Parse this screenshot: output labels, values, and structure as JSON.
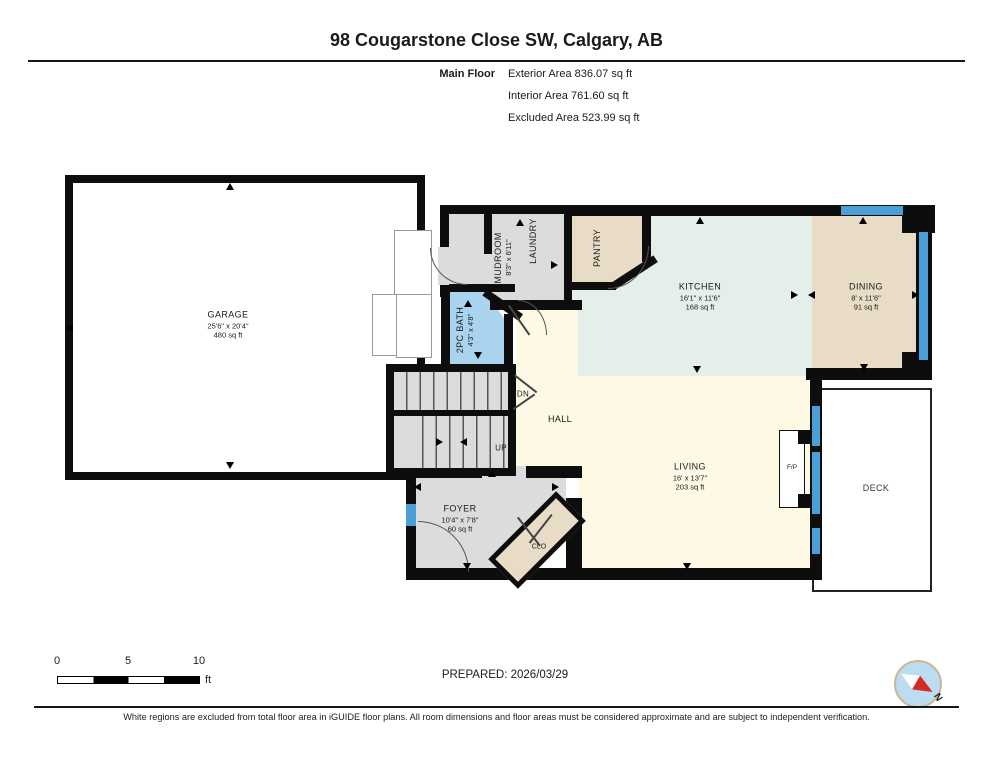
{
  "header": {
    "title": "98 Cougarstone Close SW, Calgary, AB",
    "floor_label": "Main Floor",
    "area_lines": [
      "Exterior Area 836.07 sq ft",
      "Interior Area 761.60 sq ft",
      "Excluded Area 523.99 sq ft"
    ]
  },
  "rooms": {
    "garage": {
      "name": "GARAGE",
      "dims": "25'6\" x 20'4\"",
      "area": "480 sq ft"
    },
    "mudroom": {
      "name": "MUDROOM",
      "dims": "8'3\" x 6'11\""
    },
    "laundry": {
      "name": "LAUNDRY"
    },
    "pantry": {
      "name": "PANTRY"
    },
    "kitchen": {
      "name": "KITCHEN",
      "dims": "16'1\" x 11'6\"",
      "area": "168 sq ft"
    },
    "dining": {
      "name": "DINING",
      "dims": "8' x 11'6\"",
      "area": "91 sq ft"
    },
    "bath": {
      "name": "2PC BATH",
      "dims": "4'3\" x 4'8\""
    },
    "hall": {
      "name": "HALL"
    },
    "living": {
      "name": "LIVING",
      "dims": "16' x 13'7\"",
      "area": "203 sq ft"
    },
    "foyer": {
      "name": "FOYER",
      "dims": "10'4\" x 7'8\"",
      "area": "60 sq ft"
    },
    "closet": {
      "name": "CLO"
    },
    "deck": {
      "name": "DECK"
    },
    "fireplace": {
      "name": "F/P"
    }
  },
  "stairs": {
    "down_label": "DN",
    "up_label": "UP"
  },
  "scale_bar": {
    "tick_0": "0",
    "tick_5": "5",
    "tick_10": "10",
    "unit": "ft"
  },
  "compass": {
    "north_label": "N"
  },
  "footer": {
    "prepared_label": "PREPARED: 2026/03/29",
    "disclaimer": "White regions are excluded from total floor area in iGUIDE floor plans. All room dimensions and floor areas must be considered approximate and are subject to independent verification."
  },
  "colors": {
    "wall": "#0d0d0d",
    "window": "#4a9fd8",
    "room_gray": "#dcdcdc",
    "room_tan": "#e9dcc6",
    "room_mint": "#e4efe9",
    "room_cream": "#fdf9e4",
    "room_bath_blue": "#a9d3ee",
    "compass_fill": "#bcdcf2",
    "compass_needle": "#d42a20",
    "compass_ring": "#c9b79b"
  }
}
